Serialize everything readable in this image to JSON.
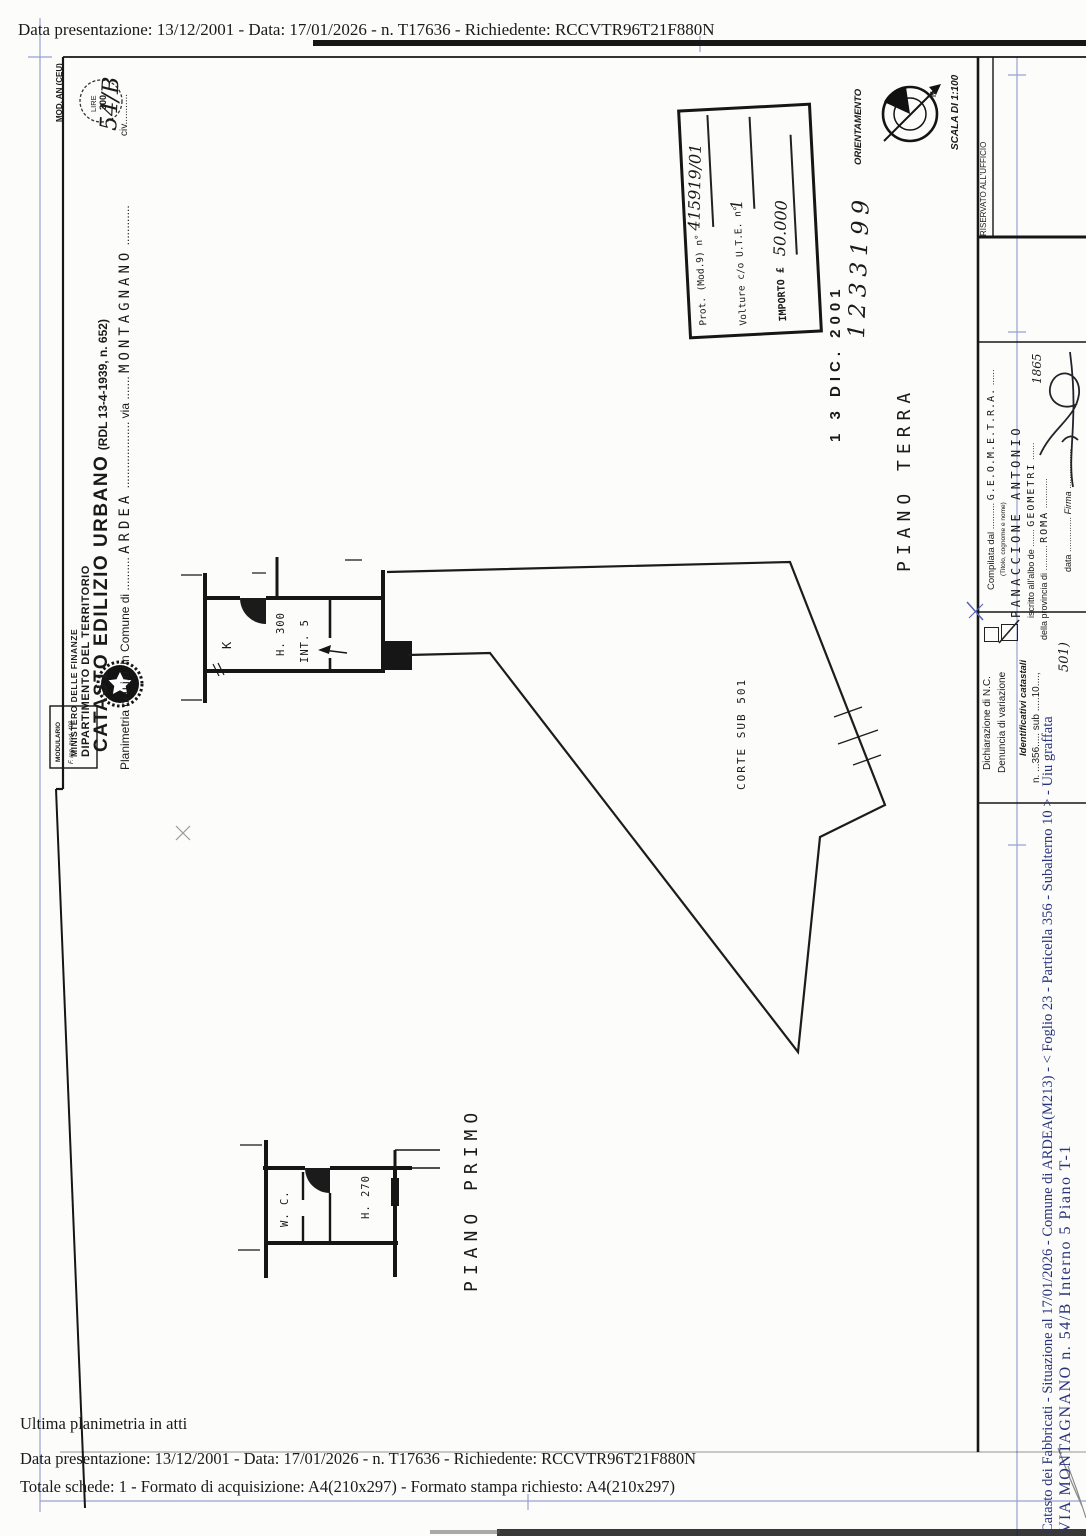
{
  "header": {
    "line": "Data presentazione: 13/12/2001 - Data: 17/01/2026 - n. T17636 - Richiedente: RCCVTR96T21F880N"
  },
  "footer": {
    "line1": "Ultima planimetria in atti",
    "line2": "Data presentazione: 13/12/2001 - Data: 17/01/2026 - n. T17636 - Richiedente: RCCVTR96T21F880N",
    "line3": "Totale schede: 1 - Formato di acquisizione: A4(210x297)  - Formato stampa richiesto: A4(210x297)"
  },
  "masthead": {
    "mod_label": "MOD. AN (CEU)",
    "lire_line1": "LIRE",
    "lire_line2": "300",
    "modulario_line1": "MODULARIO",
    "modulario_line2": "F. reg. mod. 498",
    "ministero": "MINISTERO DELLE FINANZE",
    "dipartimento": "DIPARTIMENTO DEL TERRITORIO",
    "catasto": "CATASTO EDILIZIO URBANO",
    "catasto_ref": "(RDL 13-4-1939, n. 652)"
  },
  "intestazione": {
    "label": "Planimetria di u.i.u. in Comune di",
    "dots_a": "..........",
    "comune": "ARDEA",
    "dots_b": "....................",
    "via_label": "via",
    "dots_c": ".......",
    "via_value": "MONTAGNANO",
    "dots_d": "............",
    "civ_label": "civ.",
    "civ_dots": "..........",
    "civ_value": "54/B"
  },
  "stamps": {
    "prot_label": "Prot. (Mod.9) n°",
    "prot_value": "415919/01",
    "volture_label": "Volture c/o U.T.E. n°",
    "volture_value": "1",
    "importo_label": "IMPORTO £",
    "importo_value": "50.000",
    "date_stamp": "1 3 DIC. 2001",
    "date_number": "1233199",
    "orientamento": "ORIENTAMENTO",
    "north": "N.",
    "scala": "SCALA DI 1:100",
    "riservato": "RISERVATO ALL'UFFICIO"
  },
  "compilata": {
    "label": "Compilata dal",
    "dots_a": "..........",
    "titolo_value": "G.E.O.M.E.T.R.A.",
    "dots_b": "......",
    "sub_label": "(Titolo, cognome e nome)",
    "name_value": "PANACCIONE ANTONIO",
    "albo_label": "iscritto all'albo de",
    "dots_c": ".......",
    "albo_value": "GEOMETRI",
    "dots_d": ".......",
    "prov_label": "della provincia di",
    "dots_e": "..........",
    "prov_value": "ROMA",
    "dots_f": "............",
    "prov_number": "1865",
    "data_label": "data",
    "data_dots": "..............",
    "firma_label": "Firma",
    "firma_dots": "................"
  },
  "dichiarazione": {
    "nc_label": "Dichiarazione di N.C.",
    "var_label": "Denuncia di  variazione",
    "ident_label": "Identificativi catastali",
    "ident_line": "n. ...356.....  sub  .....10....,",
    "ident_extra": "501)"
  },
  "plan": {
    "piano_terra": "PIANO TERRA",
    "piano_primo": "PIANO PRIMO",
    "corte": "CORTE  SUB  501",
    "room_k": "K",
    "h300": "H. 300",
    "int5": "INT. 5",
    "wc": "W. C.",
    "h270": "H. 270"
  },
  "annotation": {
    "line1": "Catasto dei Fabbricati - Situazione al 17/01/2026 - Comune di ARDEA(M213) - <  Foglio 23 - Particella  356 - Subalterno  10 > - Uiu graffata",
    "line2": "VIA MONTAGNANO n. 54/B  Interno 5 Piano T-1"
  },
  "colors": {
    "ink": "#1a1a1a",
    "annotation_blue": "#28327d",
    "scan_blue": "#98a1d2"
  }
}
